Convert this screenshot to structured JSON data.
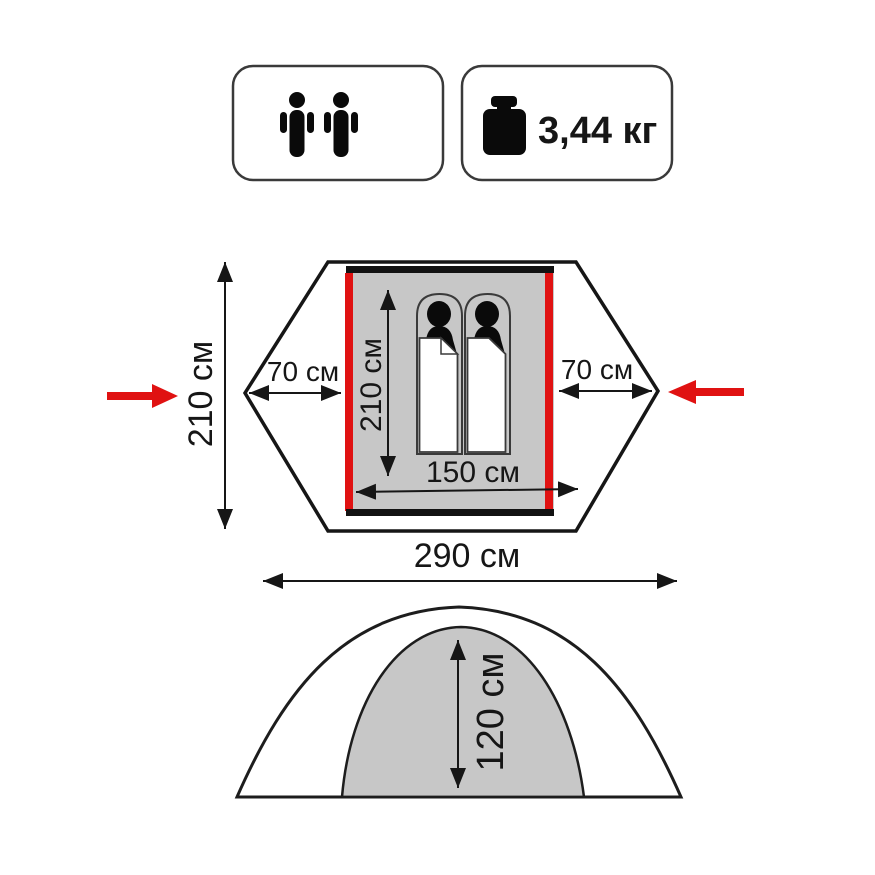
{
  "product": {
    "capacity_persons": 2,
    "weight": "3,44 кг"
  },
  "top_view": {
    "total_depth": "210 см",
    "total_width": "290 см",
    "left_vestibule": "70 см",
    "right_vestibule": "70 см",
    "inner_length": "210 см",
    "inner_width": "150 см"
  },
  "side_view": {
    "height": "120 см"
  },
  "icons": {
    "capacity": "two-persons-icon",
    "weight": "kettlebell-weight-icon",
    "entrance": "red-entrance-arrow"
  },
  "colors": {
    "entrance_red": "#e01212",
    "floor_gray": "#c7c7c7",
    "outline_black": "#161616"
  }
}
